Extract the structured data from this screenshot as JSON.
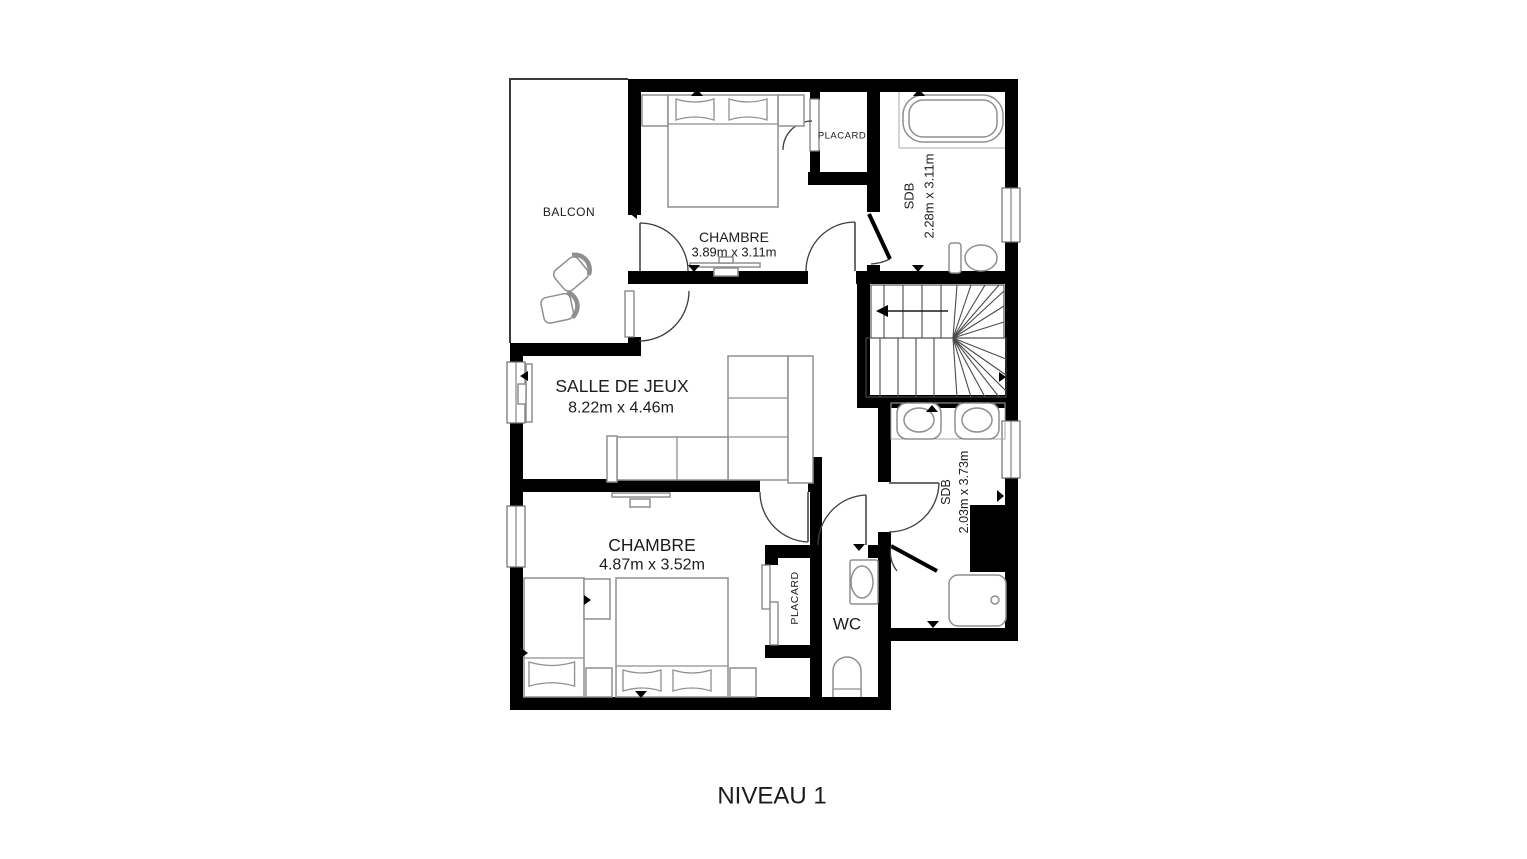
{
  "title": {
    "label": "NIVEAU 1"
  },
  "rooms": {
    "balcon": {
      "label": "BALCON"
    },
    "chambre_haut": {
      "label": "CHAMBRE",
      "dims": "3.89m x 3.11m"
    },
    "placard_haut": {
      "label": "PLACARD"
    },
    "sdb_haut": {
      "label": "SDB",
      "dims": "2.28m x 3.11m"
    },
    "salle_de_jeux": {
      "label": "SALLE DE JEUX",
      "dims": "8.22m x 4.46m"
    },
    "chambre_bas": {
      "label": "CHAMBRE",
      "dims": "4.87m x 3.52m"
    },
    "placard_bas": {
      "label": "PLACARD"
    },
    "wc": {
      "label": "WC"
    },
    "sdb_bas": {
      "label": "SDB",
      "dims": "2.03m x 3.73m"
    }
  },
  "colors": {
    "wall": "#000000",
    "furniture_outline": "#8f8f8f",
    "text": "#1c1c1c",
    "background": "#ffffff"
  }
}
